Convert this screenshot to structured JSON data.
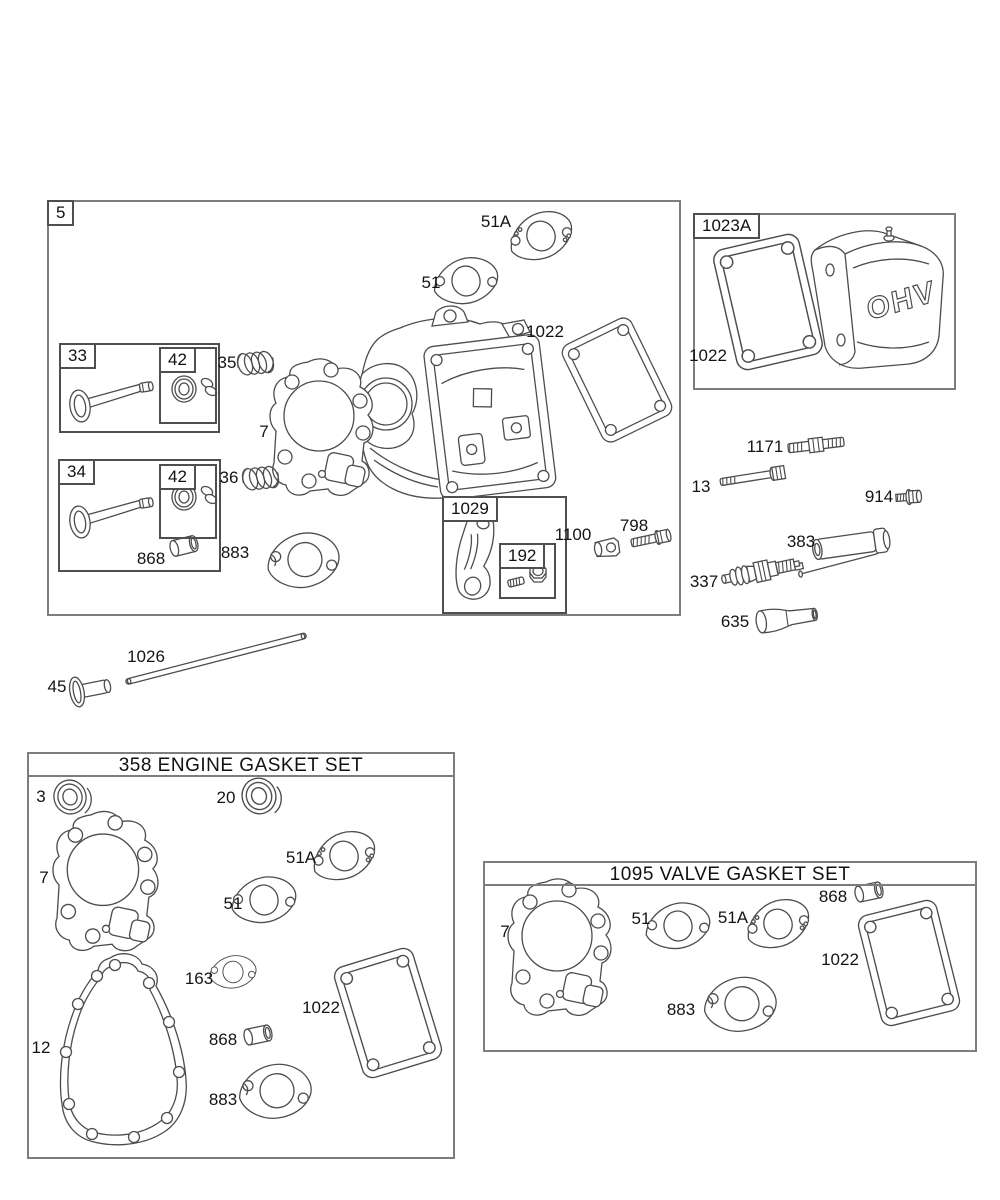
{
  "page": {
    "background": "#ffffff",
    "line_color": "#4d4d4d",
    "box_border_color": "#7d7d7d",
    "text_color": "#141414"
  },
  "cover_text": "OHV",
  "sections": {
    "head_assembly": {
      "label": "5"
    },
    "valve_cover_group": {
      "label": "1023A"
    },
    "intake_valve_group": {
      "label": "33"
    },
    "intake_seal_kit": {
      "label": "42"
    },
    "exhaust_valve_group": {
      "label": "34"
    },
    "exhaust_seal_kit": {
      "label": "42"
    },
    "rocker_arm_kit": {
      "label": "1029"
    },
    "rocker_screw_kit": {
      "label": "192"
    },
    "engine_gasket_set": {
      "title": "358 ENGINE GASKET SET"
    },
    "valve_gasket_set": {
      "title": "1095 VALVE GASKET SET"
    }
  },
  "callouts": [
    {
      "part": "51A"
    },
    {
      "part": "51"
    },
    {
      "part": "1022"
    },
    {
      "part": "35"
    },
    {
      "part": "7"
    },
    {
      "part": "36"
    },
    {
      "part": "868"
    },
    {
      "part": "883"
    },
    {
      "part": "1100"
    },
    {
      "part": "798"
    },
    {
      "part": "1171"
    },
    {
      "part": "13"
    },
    {
      "part": "914"
    },
    {
      "part": "383"
    },
    {
      "part": "337"
    },
    {
      "part": "635"
    },
    {
      "part": "1026"
    },
    {
      "part": "45"
    },
    {
      "part": "1022"
    },
    {
      "part": "3"
    },
    {
      "part": "20"
    },
    {
      "part": "7"
    },
    {
      "part": "51A"
    },
    {
      "part": "51"
    },
    {
      "part": "163"
    },
    {
      "part": "1022"
    },
    {
      "part": "12"
    },
    {
      "part": "868"
    },
    {
      "part": "883"
    },
    {
      "part": "7"
    },
    {
      "part": "51"
    },
    {
      "part": "51A"
    },
    {
      "part": "868"
    },
    {
      "part": "1022"
    },
    {
      "part": "883"
    }
  ]
}
